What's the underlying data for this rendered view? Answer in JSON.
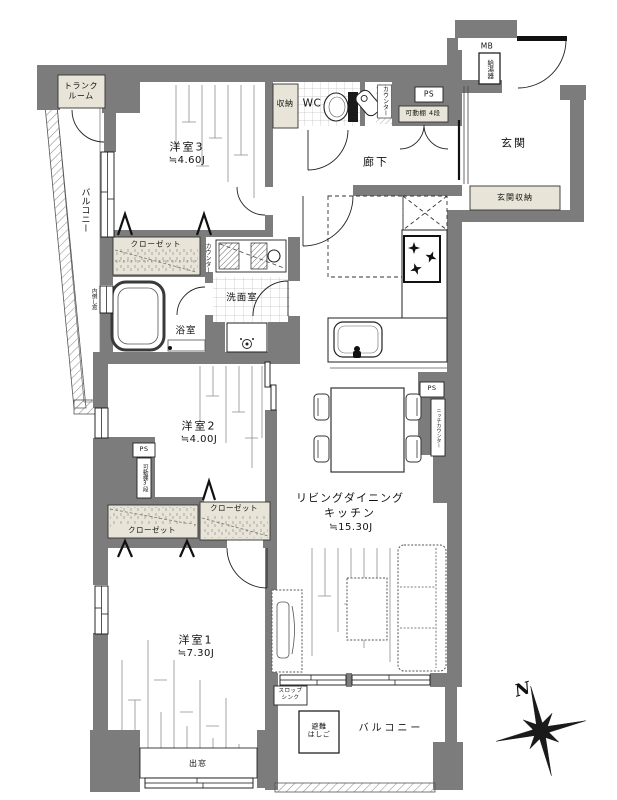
{
  "colors": {
    "wall": "#7c7c7c",
    "storage_fill": "#e8e4d7",
    "line": "#1a1a1a"
  },
  "rooms": {
    "bedroom3": {
      "name": "洋室3",
      "size": "≒4.60J"
    },
    "bedroom2": {
      "name": "洋室2",
      "size": "≒4.00J"
    },
    "bedroom1": {
      "name": "洋室1",
      "size": "≒7.30J"
    },
    "ldk": {
      "line1": "リビングダイニング",
      "line2": "キッチン",
      "size": "≒15.30J"
    },
    "entrance": {
      "name": "玄関"
    },
    "hallway": {
      "name": "廊下"
    },
    "washroom": {
      "name": "洗面室"
    },
    "bathroom": {
      "name": "浴室"
    },
    "toilet": {
      "name": "WC"
    },
    "trunk_room": {
      "name": "トランク\nルーム"
    },
    "balcony_west": {
      "name": "バルコニー"
    },
    "balcony_south": {
      "name": "バルコニー"
    }
  },
  "storage": {
    "closet_bedroom3": "クローゼット",
    "closet_lower_left": "クローゼット",
    "closet_lower_right": "クローゼット",
    "hall_storage": "収納",
    "entrance_storage": "玄関収納",
    "movable_shelf_4": "可動棚 4段",
    "movable_shelf_3": "可動棚3段"
  },
  "labels": {
    "ps": "PS",
    "mb": "MB",
    "water_heater": "給湯器",
    "counter": "カウンター",
    "niche_counter": "ニッチカウンター",
    "tilt_window": "内倒し窓",
    "bay_window": "出窓",
    "slop_sink": "スロップ\nシンク",
    "escape_ladder": "避難\nはしご",
    "north": "N"
  }
}
